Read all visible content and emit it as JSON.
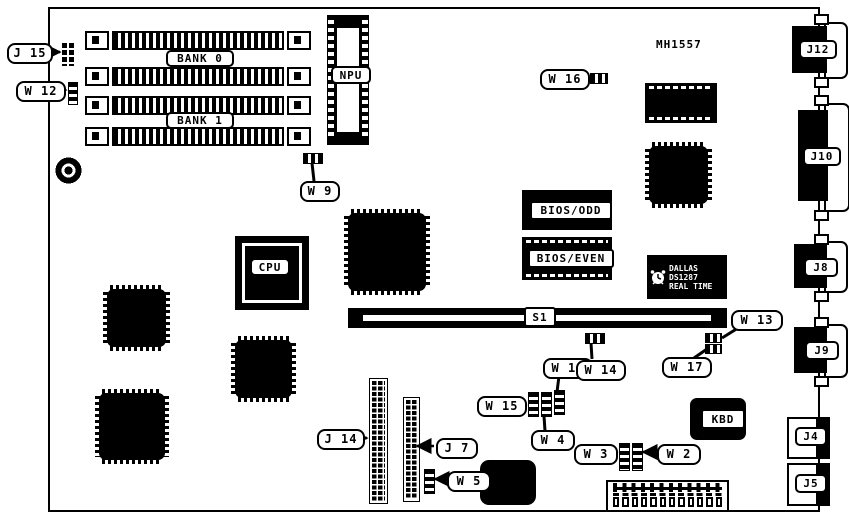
{
  "colors": {
    "ink": "#000000",
    "paper": "#ffffff"
  },
  "board_note": "MH1557",
  "labels": {
    "j15": "J 15",
    "w12": "W 12",
    "bank0": "BANK 0",
    "bank1": "BANK 1",
    "npu": "NPU",
    "w9": "W 9",
    "w16": "W 16",
    "cpu": "CPU",
    "bios_odd": "BIOS/ODD",
    "bios_even": "BIOS/EVEN",
    "s1": "S1",
    "w13": "W 13",
    "w17": "W 17",
    "w11": "W 11",
    "w14": "W 14",
    "w15": "W 15",
    "w4": "W 4",
    "j14": "J 14",
    "j7": "J 7",
    "w5": "W 5",
    "w3": "W 3",
    "w2": "W 2",
    "kbd": "KBD",
    "j12": "J12",
    "j10": "J10",
    "j8": "J8",
    "j9": "J9",
    "j4": "J4",
    "j5": "J5"
  },
  "dallas": {
    "line1": "DALLAS",
    "line2": "DS1287",
    "line3": "REAL TIME"
  }
}
